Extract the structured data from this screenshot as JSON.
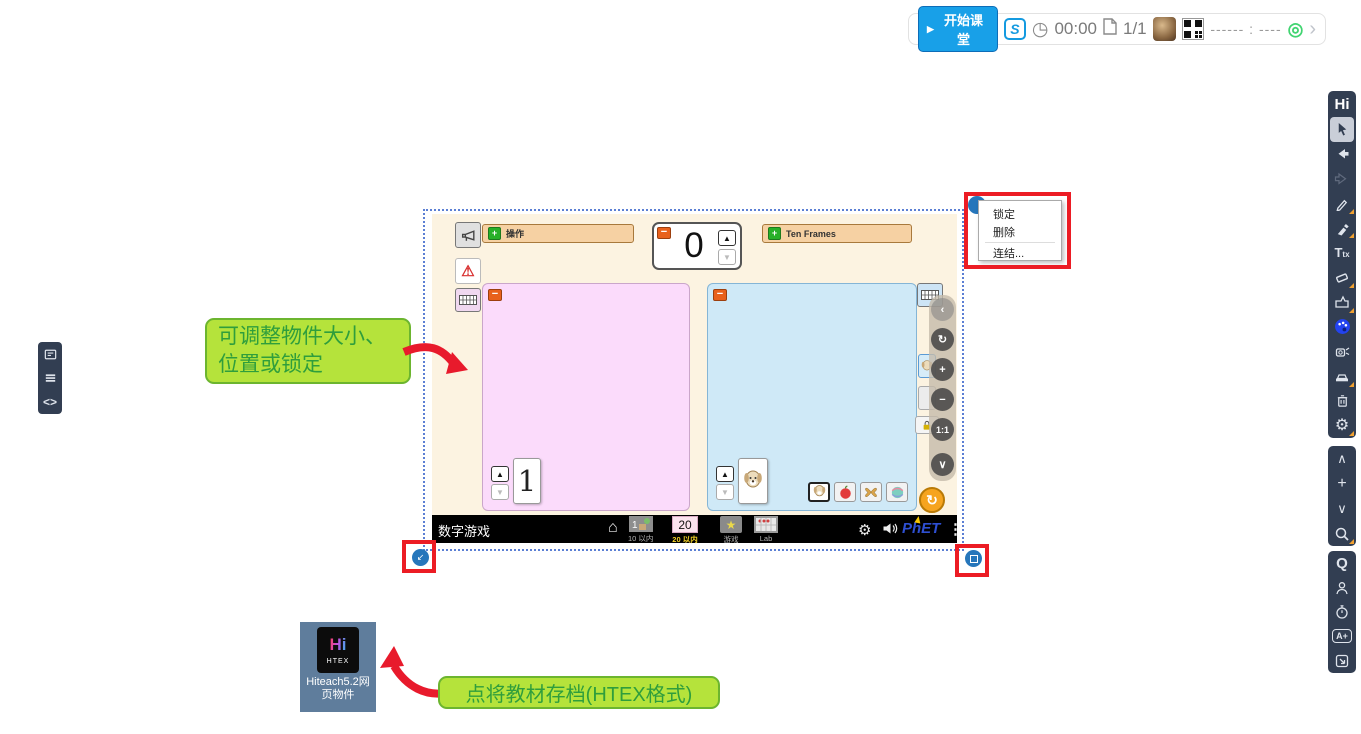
{
  "colors": {
    "accent_blue": "#18a0e8",
    "sidebar_bg": "#323e52",
    "callout_green": "#b5e33b",
    "callout_border": "#6cb52f",
    "callout_text": "#2f9e3c",
    "highlight_red": "#ec1c24",
    "handle_blue": "#2676bb",
    "accordion_orange": "#f6d1a3",
    "panel_pink": "#fbdbfb",
    "panel_blue": "#cfe9f7",
    "sim_background": "#fcf3e1",
    "phet_blue": "#2e4fd2",
    "active_tab_yellow": "#f5d327"
  },
  "top_bar": {
    "start_button_label": "开始课堂",
    "timer": "00:00",
    "page_indicator": "1/1",
    "session_code": "------ : ----"
  },
  "icons": {
    "play": "▶",
    "clock": "◷",
    "sokrates": "S",
    "broadcast": "◎",
    "chevron_right": "›",
    "kebab": "⋮",
    "home": "⌂",
    "gear": "⚙",
    "warning": "⚠",
    "up": "▲",
    "down": "▼",
    "minus": "−",
    "plus": "+",
    "refresh": "↻",
    "code": "<>",
    "chevron_up": "∧",
    "chevron_down": "∨",
    "star": "★",
    "resize_left": "↙"
  },
  "sidebar": {
    "logo": "Hi",
    "text_tool": "T",
    "text_tool_sub": "tx",
    "quiz": "Q",
    "score": "A+"
  },
  "context_menu": {
    "items": [
      "锁定",
      "删除",
      "连结..."
    ]
  },
  "callouts": {
    "resize": "可调整物件大小、位置或锁定",
    "archive": "点将教材存档(HTEX格式)"
  },
  "desktop_icon": {
    "logo": "Hi",
    "format": "HTEX",
    "label": "Hiteach5.2网页物件"
  },
  "sim": {
    "title": "数字游戏",
    "accordion_left": "操作",
    "accordion_right": "Ten Frames",
    "counter_value": "0",
    "word_card": "1",
    "brand": "PhET",
    "nav": {
      "tab1_label": "10 以内",
      "tab2_label": "20 以内",
      "tab2_value": "20",
      "tab3_label": "游戏",
      "tab4_label": "Lab"
    },
    "object_toolbar": [
      "‹",
      "↻",
      "+",
      "−",
      "1:1",
      "∨"
    ]
  }
}
